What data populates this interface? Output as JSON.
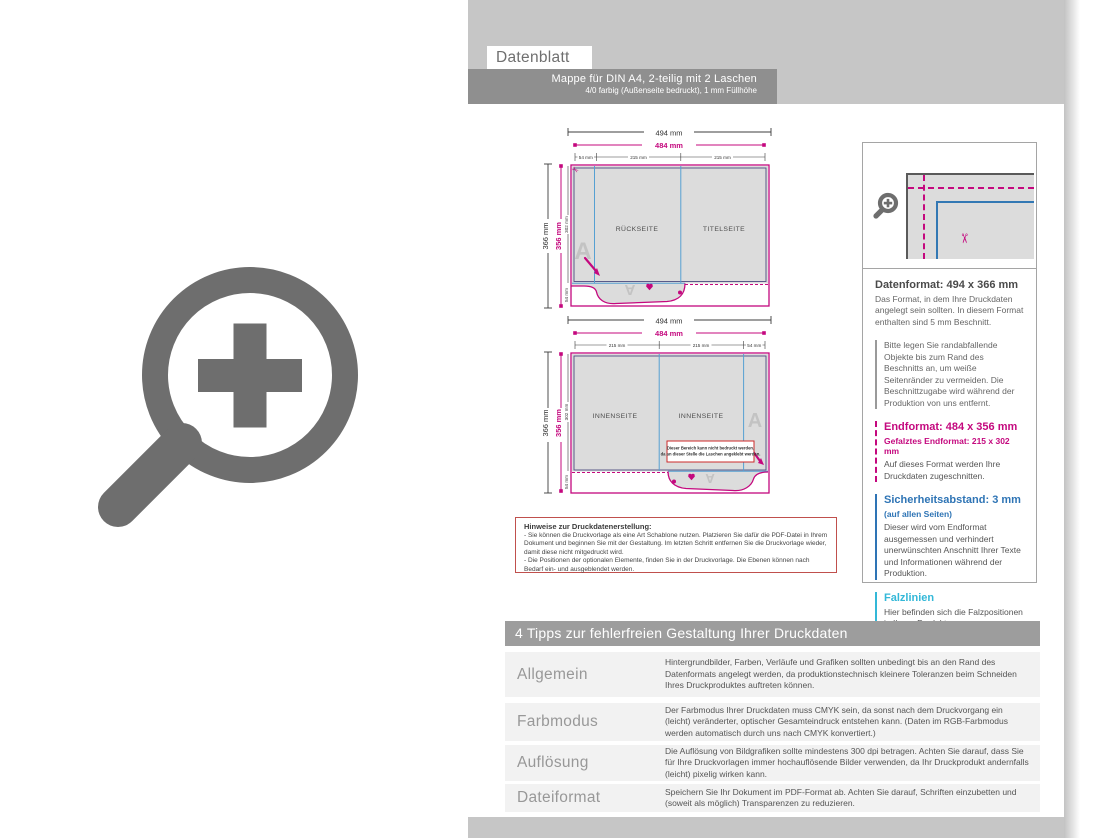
{
  "page": {
    "label": "Datenblatt"
  },
  "header": {
    "title": "Mappe für DIN A4, 2-teilig mit 2 Laschen",
    "subtitle": "4/0 farbig (Außenseite bedruckt), 1 mm Füllhöhe"
  },
  "diagram": {
    "outer_width": "494 mm",
    "inner_width": "484 mm",
    "panel_width": "215 mm",
    "flap_width": "54 mm",
    "outer_height": "366 mm",
    "inner_height": "356 mm",
    "folded_height": "302 mm",
    "flap_height": "54 mm",
    "watermark": "A",
    "outside": {
      "left_panel": "RÜCKSEITE",
      "right_panel": "TITELSEITE"
    },
    "inside": {
      "left_panel": "INNENSEITE",
      "right_panel": "INNENSEITE",
      "note_line1": "Dieser Bereich kann nicht bedruckt werden,",
      "note_line2": "da an dieser Stelle die Laschen angeklebt werden."
    }
  },
  "hints": {
    "title": "Hinweise zur Druckdatenerstellung:",
    "bullet1": "- Sie können die Druckvorlage als eine Art Schablone nutzen. Platzieren Sie dafür die PDF-Datei in Ihrem Dokument und beginnen Sie mit der Gestaltung. Im letzten Schritt entfernen Sie die Druckvorlage wieder, damit diese nicht mitgedruckt wird.",
    "bullet2": "- Die Positionen der optionalen Elemente, finden Sie in der Druckvorlage. Die Ebenen können nach Bedarf ein- und ausgeblendet werden."
  },
  "info_panel": {
    "datenformat": {
      "title": "Datenformat: 494 x 366 mm",
      "body": "Das Format, in dem Ihre Druckdaten angelegt sein sollten. In diesem Format enthalten sind 5 mm Beschnitt.",
      "note": "Bitte legen Sie randabfallende Objekte bis zum Rand des Beschnitts an, um weiße Seitenränder zu vermeiden. Die Beschnittzugabe wird während der Produktion von uns entfernt."
    },
    "endformat": {
      "title": "Endformat: 484 x 356 mm",
      "subtitle": "Gefalztes Endformat: 215 x 302 mm",
      "body": "Auf dieses Format werden Ihre Druckdaten zugeschnitten."
    },
    "sicherheitsabstand": {
      "title": "Sicherheitsabstand: 3 mm",
      "subtitle": "(auf allen Seiten)",
      "body": "Dieser wird vom Endformat ausgemessen und verhindert unerwünschten Anschnitt Ihrer Texte und Informationen während der Produktion."
    },
    "falzlinien": {
      "title": "Falzlinien",
      "body": "Hier befinden sich die Falzpositionen in Ihrem Produkt."
    }
  },
  "tips": {
    "title": "4 Tipps zur fehlerfreien Gestaltung Ihrer Druckdaten",
    "rows": [
      {
        "label": "Allgemein",
        "text": "Hintergrundbilder, Farben, Verläufe und Grafiken sollten unbedingt bis an den Rand des Datenformats angelegt werden, da produktionstechnisch kleinere Toleranzen beim Schneiden Ihres Druckproduktes auftreten können."
      },
      {
        "label": "Farbmodus",
        "text": "Der Farbmodus Ihrer Druckdaten muss CMYK sein, da sonst nach dem Druckvorgang ein (leicht) veränderter, optischer Gesamteindruck entstehen kann. (Daten im RGB-Farbmodus werden automatisch durch uns nach CMYK konvertiert.)"
      },
      {
        "label": "Auflösung",
        "text": "Die Auflösung von Bildgrafiken sollte mindestens 300 dpi betragen. Achten Sie darauf, dass Sie für Ihre Druckvorlagen immer hochauflösende Bilder verwenden, da Ihr Druckprodukt andernfalls (leicht) pixelig wirken kann."
      },
      {
        "label": "Dateiformat",
        "text": "Speichern Sie Ihr Dokument im PDF-Format ab. Achten Sie darauf, Schriften einzubetten und (soweit als möglich) Transparenzen zu reduzieren."
      }
    ]
  },
  "colors": {
    "magenta_cut": "#c4087e",
    "blue_safety": "#2e74b5",
    "cyan_fold": "#33b8d8",
    "page_gray": "#c6c6c6",
    "bar_gray": "#8f8f8f"
  }
}
